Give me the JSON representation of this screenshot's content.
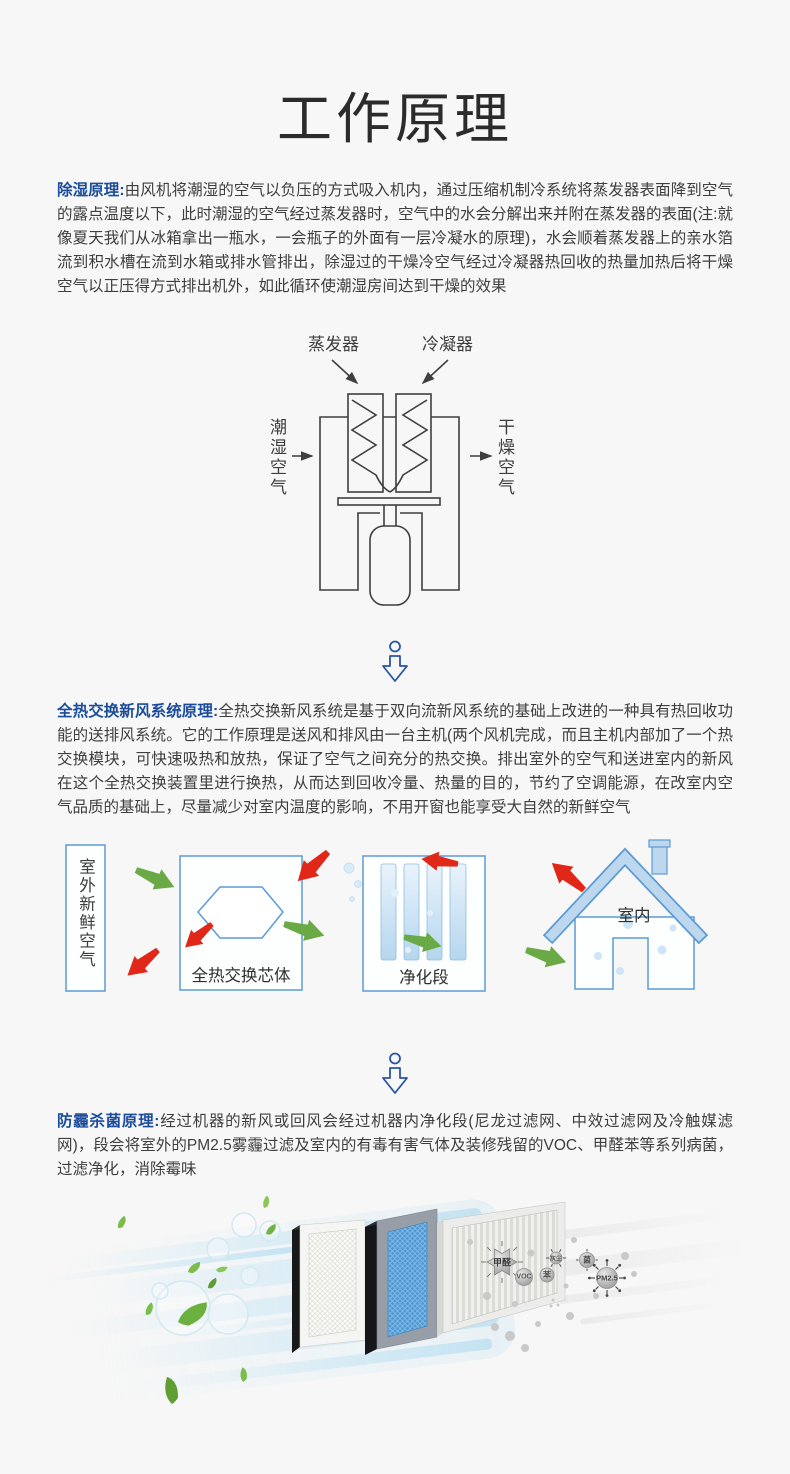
{
  "title": "工作原理",
  "sections": [
    {
      "label": "除湿原理:",
      "text": "由风机将潮湿的空气以负压的方式吸入机内，通过压缩机制冷系统将蒸发器表面降到空气的露点温度以下，此时潮湿的空气经过蒸发器时，空气中的水会分解出来并附在蒸发器的表面(注:就像夏天我们从冰箱拿出一瓶水，一会瓶子的外面有一层冷凝水的原理)，水会顺着蒸发器上的亲水箔流到积水槽在流到水箱或排水管排出，除湿过的干燥冷空气经过冷凝器热回收的热量加热后将干燥空气以正压得方式排出机外，如此循环使潮湿房间达到干燥的效果"
    },
    {
      "label": "全热交换新风系统原理:",
      "text": "全热交换新风系统是基于双向流新风系统的基础上改进的一种具有热回收功能的送排风系统。它的工作原理是送风和排风由一台主机(两个风机完成，而且主机内部加了一个热交换模块，可快速吸热和放热，保证了空气之间充分的热交换。排出室外的空气和送进室内的新风在这个全热交换装置里进行换热，从而达到回收冷量、热量的目的，节约了空调能源，在改室内空气品质的基础上，尽量减少对室内温度的影响，不用开窗也能享受大自然的新鲜空气"
    },
    {
      "label": "防霾杀菌原理:",
      "text": "经过机器的新风或回风会经过机器内净化段(尼龙过滤网、中效过滤网及冷触媒滤网)，段会将室外的PM2.5雾霾过滤及室内的有毒有害气体及装修残留的VOC、甲醛苯等系列病菌，过滤净化，消除霉味"
    }
  ],
  "diagram_dehumidify": {
    "evaporator": "蒸发器",
    "condenser": "冷凝器",
    "inlet_air": "潮湿空气",
    "outlet_air": "干燥空气"
  },
  "diagram_heat_exchange": {
    "outdoor_air": "室外新鲜空气",
    "core": "全热交换芯体",
    "purification": "净化段",
    "indoor": "室内"
  },
  "filter_scene": {
    "pollutants": [
      "甲醛",
      "VOC",
      "苯",
      "灰尘",
      "菌",
      "PM2.5"
    ]
  },
  "colors": {
    "accent_blue": "#1b4c9c",
    "diagram_blue": "#5b9bd5",
    "green_arrow": "#6aaa46",
    "red_arrow": "#e02718",
    "background": "#f7f7f7"
  }
}
